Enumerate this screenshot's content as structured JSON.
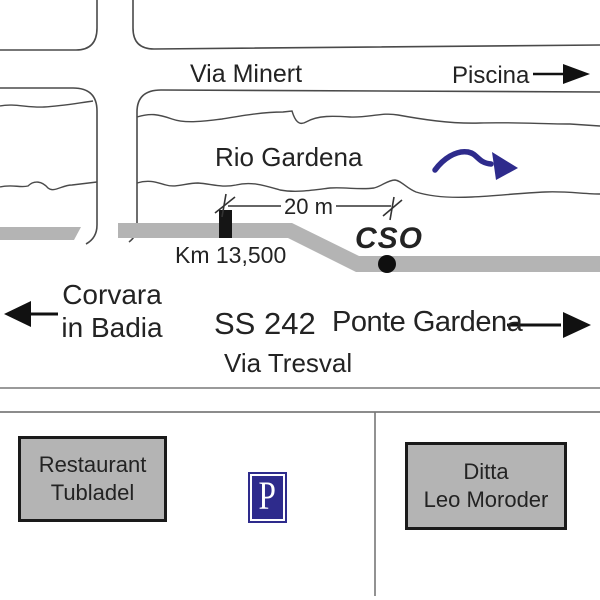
{
  "title": "Hand-drawn directions map",
  "colors": {
    "road_gray": "#b4b4b4",
    "line_gray": "#4a4a4a",
    "text": "#232323",
    "navy_blue": "#2e2b8c",
    "black": "#151515",
    "box_fill": "#b4b4b4",
    "box_border": "#1a1a1a"
  },
  "labels": {
    "via_minert": "Via Minert",
    "piscina": "Piscina",
    "rio_gardena": "Rio Gardena",
    "distance": "20 m",
    "km_marker": "Km 13,500",
    "cso": "CSO",
    "corvara_line1": "Corvara",
    "corvara_line2": "in Badia",
    "ss242": "SS 242",
    "ponte_gardena": "Ponte Gardena",
    "via_tresval": "Via Tresval"
  },
  "buildings": {
    "restaurant_line1": "Restaurant",
    "restaurant_line2": "Tubladel",
    "ditta_line1": "Ditta",
    "ditta_line2": "Leo Moroder",
    "parking": "P"
  },
  "icons": {
    "piscina_arrow": "arrow-right",
    "corvara_arrow": "arrow-left",
    "ponte_arrow": "arrow-right",
    "river_flow_arrow": "wavy-arrow-right",
    "cso_dot": "location-dot",
    "km_stone": "kilometer-stone",
    "parking": "parking-sign"
  }
}
